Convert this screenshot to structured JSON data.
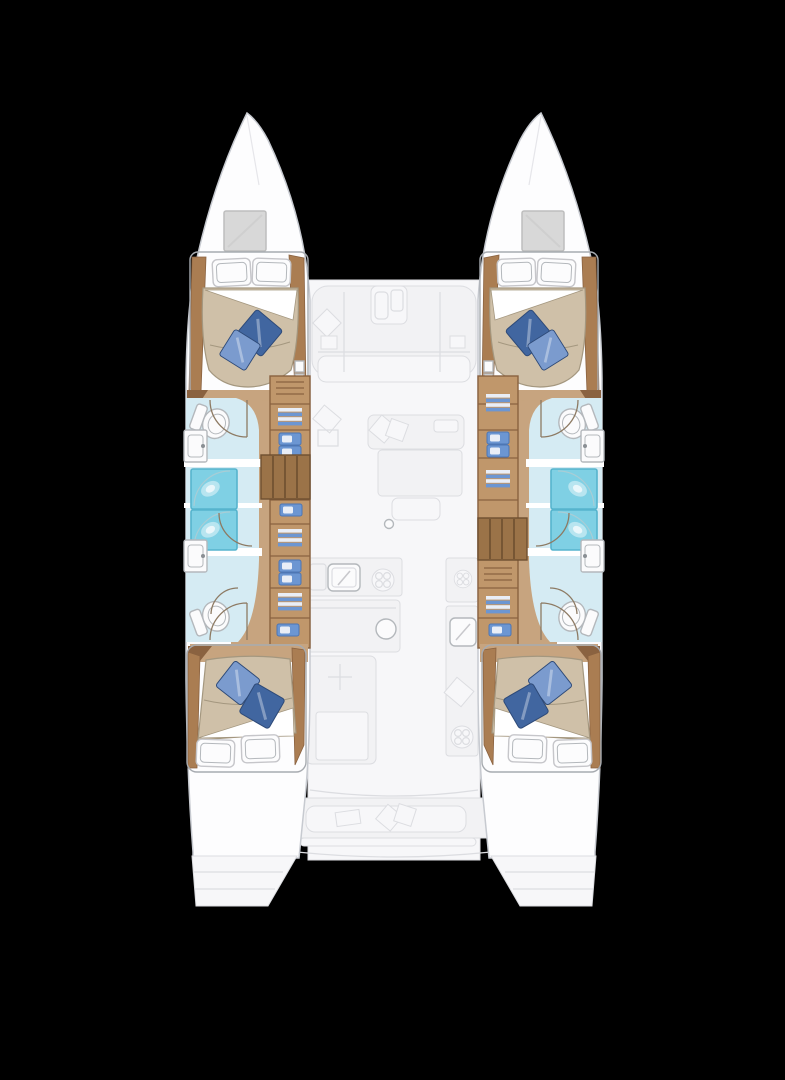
{
  "scene": {
    "type": "floor-plan-diagram",
    "subject": "catamaran yacht interior deck plan, top-down view",
    "background": "black",
    "text_visible": "none"
  },
  "palette": {
    "bg": "#000000",
    "hull": "#fdfdfe",
    "hullLine": "#c7cad0",
    "ghostFill": "#f2f2f4",
    "ghostFloor": "#f7f7f9",
    "ghostLine": "#dcdde1",
    "floorTan": "#c7a47f",
    "woodTrim": "#aa7d52",
    "woodDark": "#8a6240",
    "cabinetFill": "#c0976b",
    "cabinetFrame": "#8a6240",
    "stairWood": "#9b7348",
    "stairLine": "#6e4f30",
    "bedBeige": "#cfc0a8",
    "bedLine": "#a4977f",
    "sheet": "#ffffff",
    "pillowWhite": "#fcfcfd",
    "pillowLine": "#c6c6ca",
    "cushionDark": "#4166a0",
    "cushionLight": "#7b9bce",
    "cushionLine": "#2e4a78",
    "bathFloor": "#d5ebf3",
    "shower": "#7fd0e4",
    "showerEdge": "#56b4cd",
    "fixtureWhite": "#fbfbfc",
    "fixtureLine": "#b4b8bc",
    "wardrobeBlue": "#6c96d2",
    "wardrobeBlueDark": "#4d76b4",
    "linenWhite": "#e9eef7",
    "doorArc": "#8d7a63"
  },
  "layout": {
    "hulls": [
      {
        "side": "port",
        "rooms": [
          "forward-cabin",
          "forward-bathroom",
          "shower",
          "shower",
          "aft-bathroom",
          "aft-cabin"
        ],
        "fixtures": {
          "double_beds": 2,
          "toilets": 2,
          "sinks": 2,
          "showers": 2,
          "companionway_stairs": 1,
          "wardrobe_units": 8,
          "bow_hatch": 1,
          "blue_cushions": 4,
          "white_pillows": 4
        }
      },
      {
        "side": "starboard",
        "rooms": [
          "forward-cabin",
          "forward-bathroom",
          "shower",
          "shower",
          "aft-bathroom",
          "aft-cabin"
        ],
        "fixtures": {
          "double_beds": 2,
          "toilets": 2,
          "sinks": 2,
          "showers": 2,
          "companionway_stairs": 1,
          "wardrobe_units": 8,
          "bow_hatch": 1,
          "blue_cushions": 4,
          "white_pillows": 4
        }
      }
    ],
    "center_nacelle": {
      "zones": [
        "forward-lounge",
        "saloon",
        "galley",
        "cockpit",
        "transom-steps"
      ],
      "fixtures": {
        "lounge_console": 1,
        "saloon_table": 1,
        "saloon_sofa": 1,
        "galley_sinks": 3,
        "stove_burners": 3,
        "mast_post": 1,
        "cockpit_bench": 1,
        "transom_platforms": 2
      }
    },
    "totals": {
      "cabins": 4,
      "bathrooms": 4,
      "showers": 4,
      "hulls": 2
    }
  }
}
